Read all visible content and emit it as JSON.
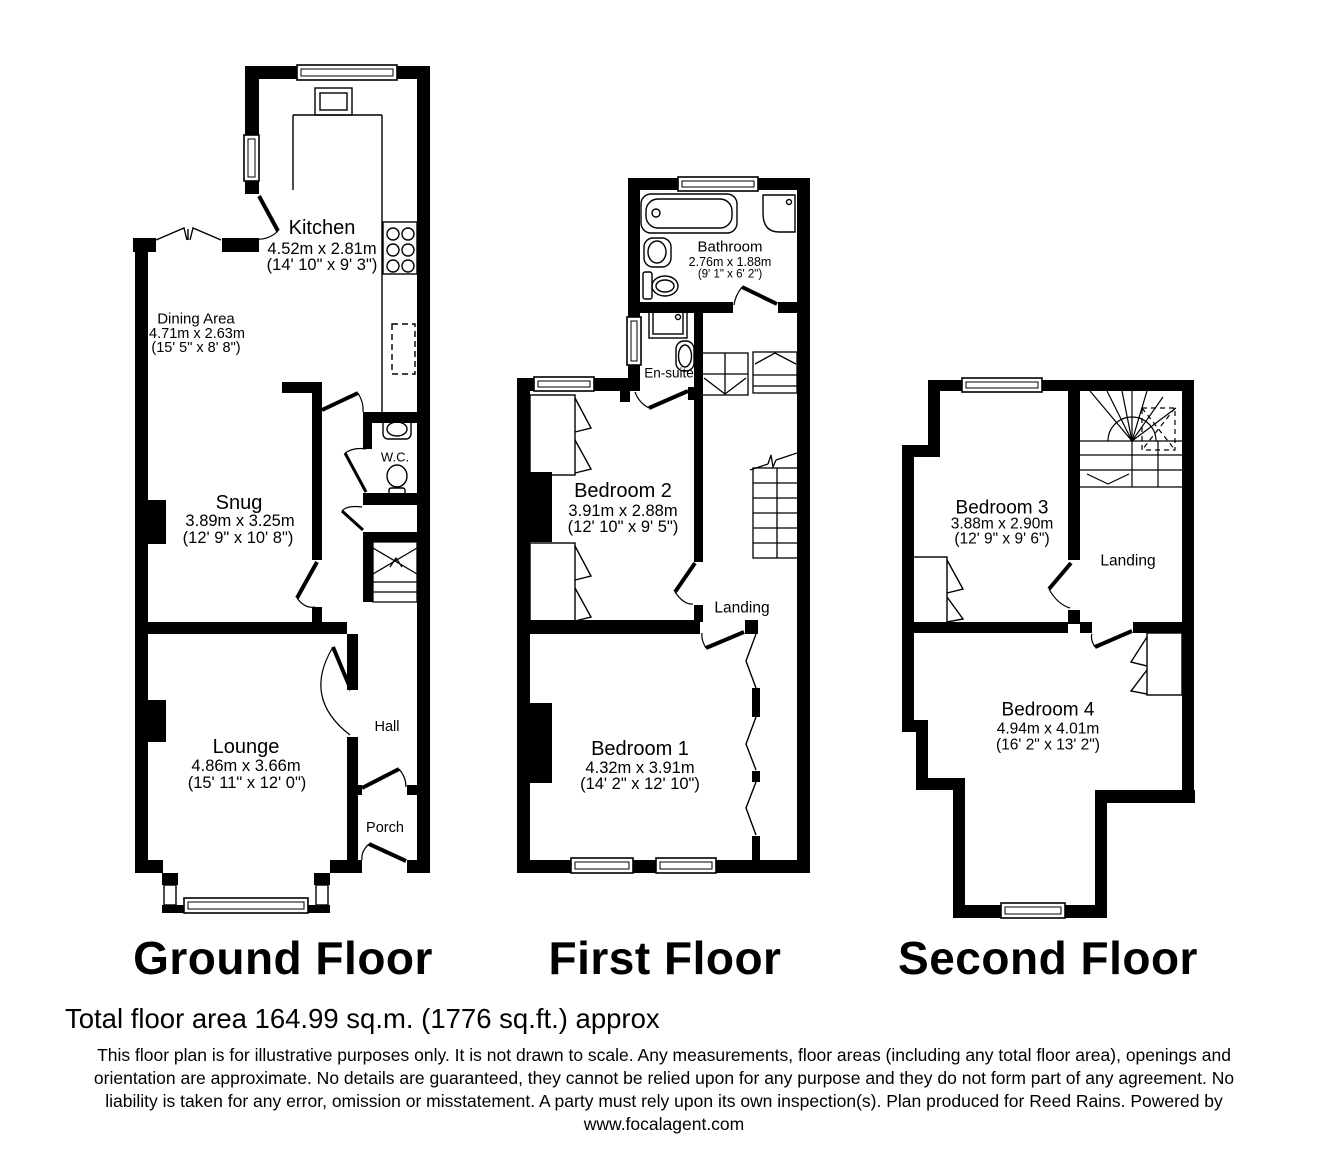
{
  "document": {
    "type": "floor-plan"
  },
  "colors": {
    "wall": "#000000",
    "background": "#ffffff",
    "text": "#000000"
  },
  "floors": {
    "ground": {
      "title": "Ground Floor",
      "rooms": {
        "kitchen": {
          "name": "Kitchen",
          "metric": "4.52m x 2.81m",
          "imperial": "(14' 10\" x 9' 3\")"
        },
        "dining_area": {
          "name": "Dining Area",
          "metric": "4.71m x 2.63m",
          "imperial": "(15' 5\" x 8' 8\")"
        },
        "snug": {
          "name": "Snug",
          "metric": "3.89m x 3.25m",
          "imperial": "(12' 9\" x 10' 8\")"
        },
        "wc": {
          "name": "W.C."
        },
        "lounge": {
          "name": "Lounge",
          "metric": "4.86m x 3.66m",
          "imperial": "(15' 11\" x 12' 0\")"
        },
        "hall": {
          "name": "Hall"
        },
        "porch": {
          "name": "Porch"
        }
      }
    },
    "first": {
      "title": "First Floor",
      "rooms": {
        "bathroom": {
          "name": "Bathroom",
          "metric": "2.76m x 1.88m",
          "imperial": "(9' 1\" x 6' 2\")"
        },
        "en_suite": {
          "name": "En-suite"
        },
        "bedroom2": {
          "name": "Bedroom 2",
          "metric": "3.91m x 2.88m",
          "imperial": "(12' 10\" x 9' 5\")"
        },
        "landing": {
          "name": "Landing"
        },
        "bedroom1": {
          "name": "Bedroom 1",
          "metric": "4.32m x 3.91m",
          "imperial": "(14' 2\" x 12' 10\")"
        }
      }
    },
    "second": {
      "title": "Second Floor",
      "rooms": {
        "bedroom3": {
          "name": "Bedroom 3",
          "metric": "3.88m x 2.90m",
          "imperial": "(12' 9\" x 9' 6\")"
        },
        "landing": {
          "name": "Landing"
        },
        "bedroom4": {
          "name": "Bedroom 4",
          "metric": "4.94m x 4.01m",
          "imperial": "(16' 2\" x 13' 2\")"
        }
      }
    }
  },
  "footer": {
    "total_area": "Total floor area 164.99 sq.m. (1776 sq.ft.) approx",
    "disclaimer_lines": [
      "This floor plan is for illustrative purposes only. It is not drawn to scale. Any measurements, floor areas (including any total floor area), openings and",
      "orientation are approximate. No details are guaranteed, they cannot be relied upon for any purpose and they do not form part of any agreement. No",
      "liability is taken for any error, omission or misstatement. A party must rely upon its own inspection(s). Plan produced for Reed Rains. Powered by",
      "www.focalagent.com"
    ]
  }
}
